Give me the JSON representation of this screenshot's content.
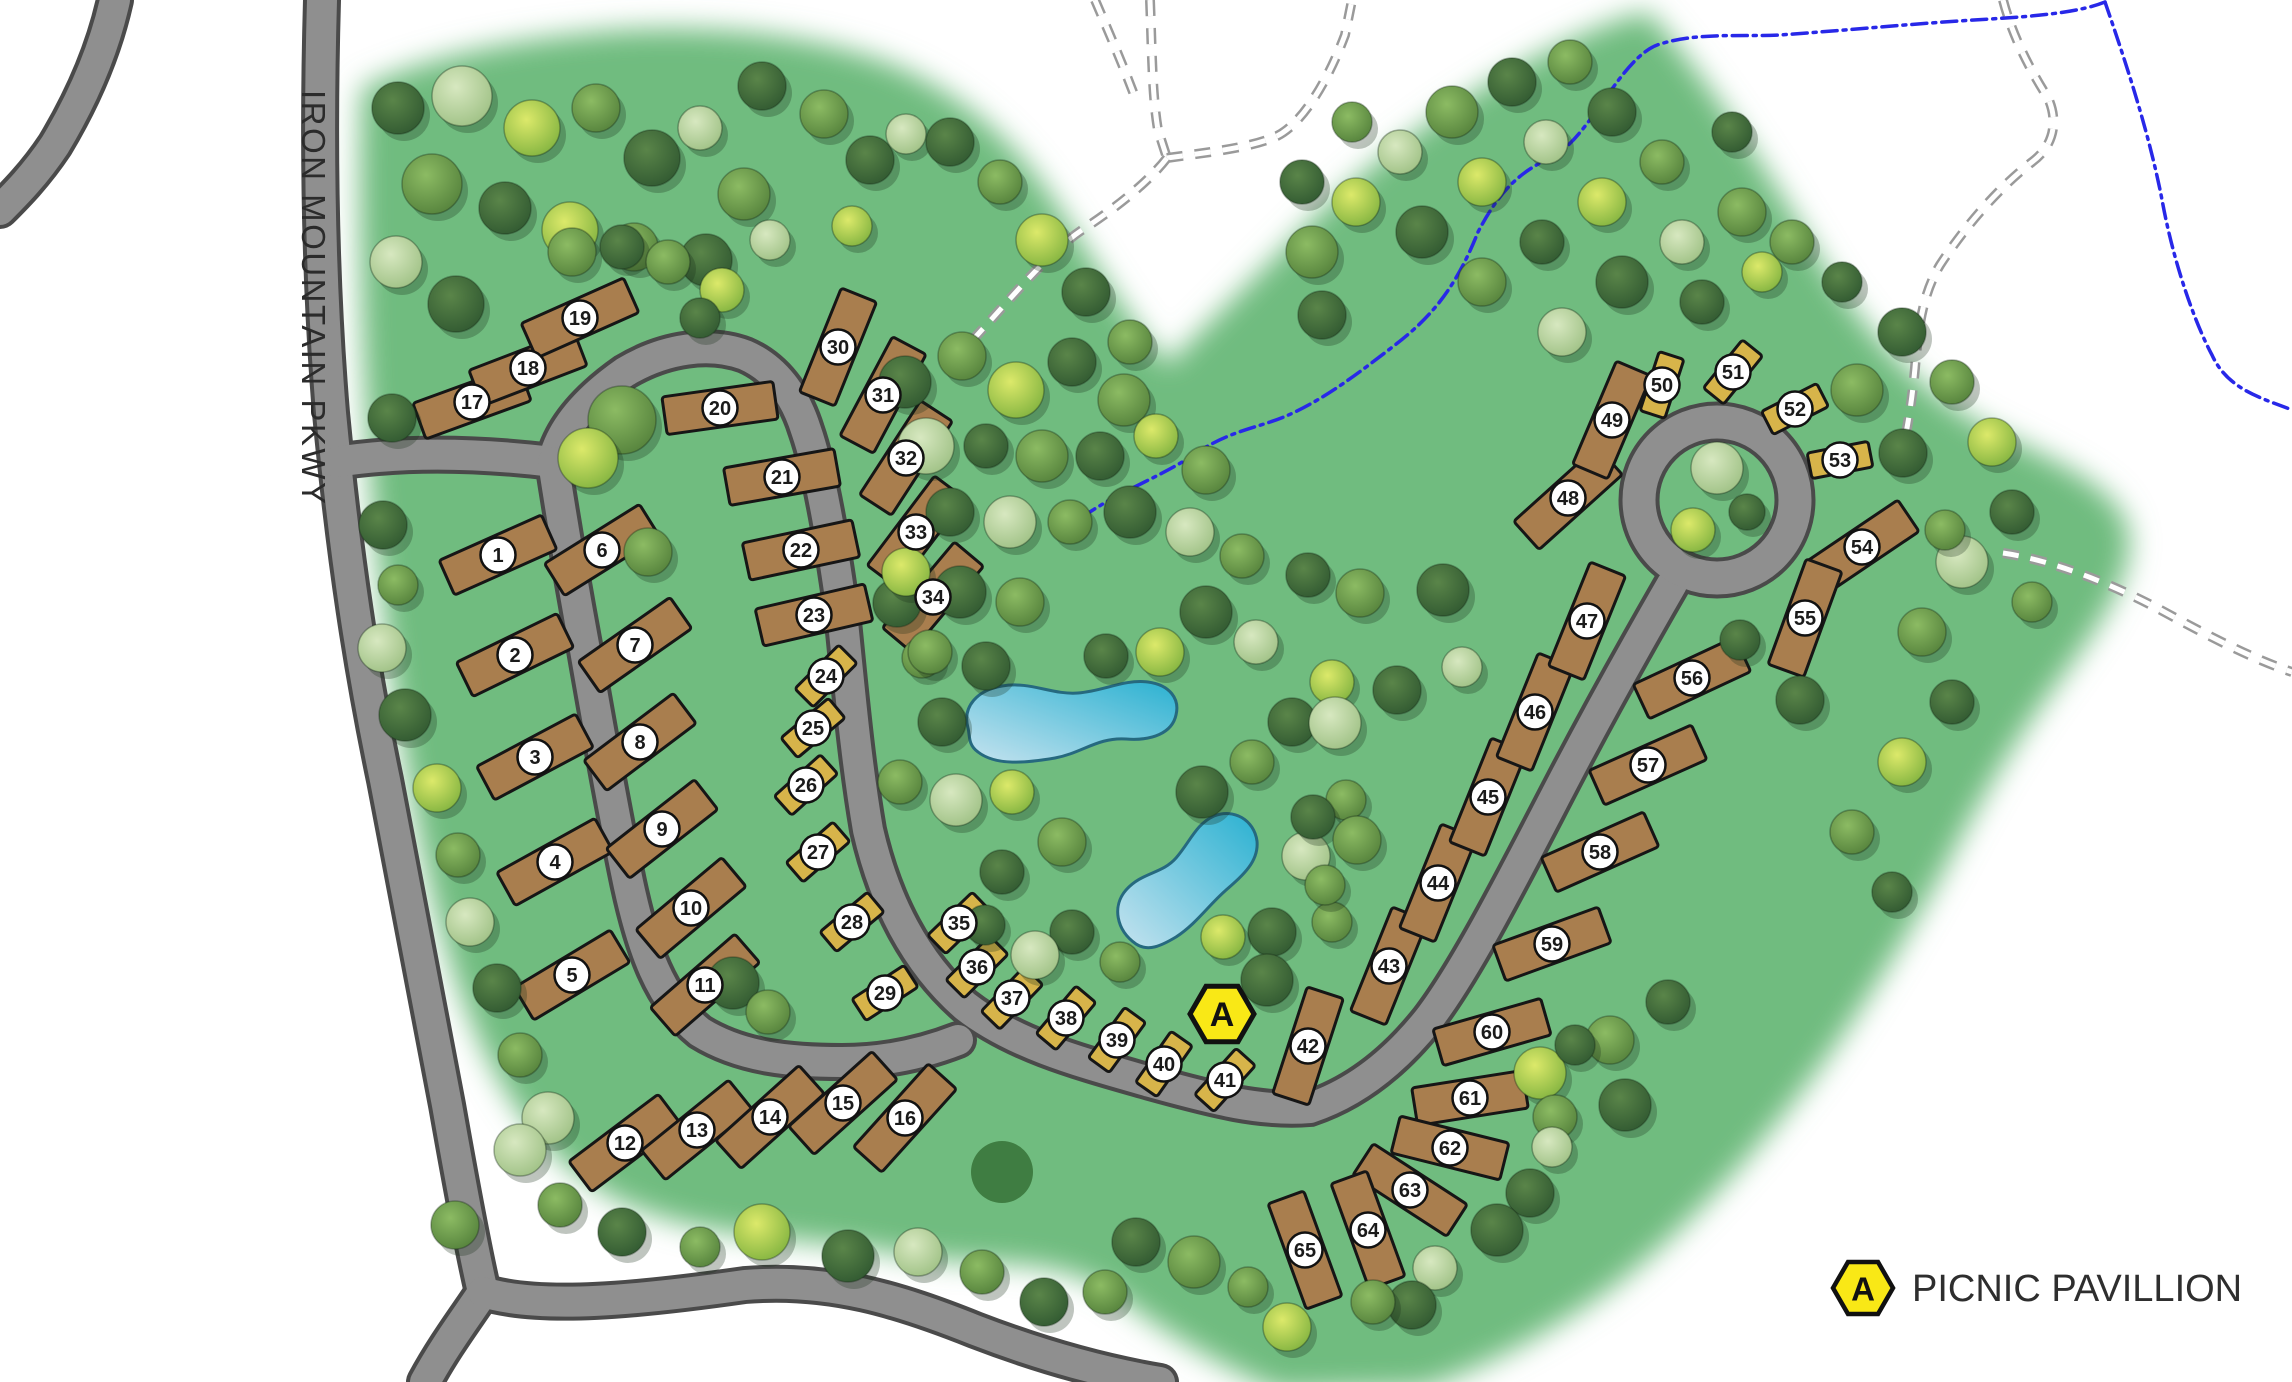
{
  "road_label": "IRON MOUNTAIN PKWY",
  "legend": {
    "symbol": "A",
    "label": "PICNIC PAVILLION"
  },
  "pavilion": {
    "symbol": "A",
    "x": 1222,
    "y": 1014
  },
  "colors": {
    "grass": "#6fbc7f",
    "road": "#8f8f8f",
    "road_casing": "#4a4a4a",
    "lot_large": "#a97e4e",
    "lot_small": "#d7b44a",
    "lot_outline": "#161616",
    "stream": "#2828e8",
    "trail": "#9a9a9a",
    "pond_edge": "#26697f",
    "pavilion_fill": "#f9e816",
    "grove": "#3f7d42",
    "badge_fill": "#ffffff",
    "badge_stroke": "#111111",
    "badge_text": "#1a1a1a"
  },
  "grove": {
    "x": 1002,
    "y": 1172,
    "r": 31
  },
  "ring": {
    "x": 1717,
    "y": 500,
    "r": 78
  },
  "lots": [
    {
      "n": 1,
      "x": 498,
      "y": 555,
      "rot": -24,
      "size": "L"
    },
    {
      "n": 2,
      "x": 515,
      "y": 655,
      "rot": -26,
      "size": "L"
    },
    {
      "n": 3,
      "x": 535,
      "y": 757,
      "rot": -28,
      "size": "L"
    },
    {
      "n": 4,
      "x": 555,
      "y": 862,
      "rot": -29,
      "size": "L"
    },
    {
      "n": 5,
      "x": 572,
      "y": 975,
      "rot": -31,
      "size": "L"
    },
    {
      "n": 6,
      "x": 602,
      "y": 550,
      "rot": -32,
      "size": "L"
    },
    {
      "n": 7,
      "x": 635,
      "y": 645,
      "rot": -35,
      "size": "L"
    },
    {
      "n": 8,
      "x": 640,
      "y": 742,
      "rot": -37,
      "size": "L"
    },
    {
      "n": 9,
      "x": 662,
      "y": 829,
      "rot": -38,
      "size": "L"
    },
    {
      "n": 10,
      "x": 691,
      "y": 908,
      "rot": -40,
      "size": "L"
    },
    {
      "n": 11,
      "x": 705,
      "y": 985,
      "rot": -41,
      "size": "L"
    },
    {
      "n": 12,
      "x": 625,
      "y": 1143,
      "rot": -37,
      "size": "L"
    },
    {
      "n": 13,
      "x": 697,
      "y": 1130,
      "rot": -39,
      "size": "L"
    },
    {
      "n": 14,
      "x": 770,
      "y": 1117,
      "rot": -42,
      "size": "L"
    },
    {
      "n": 15,
      "x": 843,
      "y": 1103,
      "rot": -42,
      "size": "L"
    },
    {
      "n": 16,
      "x": 905,
      "y": 1118,
      "rot": -48,
      "size": "L"
    },
    {
      "n": 17,
      "x": 472,
      "y": 402,
      "rot": -20,
      "size": "L"
    },
    {
      "n": 18,
      "x": 528,
      "y": 368,
      "rot": -21,
      "size": "L"
    },
    {
      "n": 19,
      "x": 580,
      "y": 318,
      "rot": -24,
      "size": "L"
    },
    {
      "n": 20,
      "x": 720,
      "y": 408,
      "rot": -8,
      "size": "L"
    },
    {
      "n": 21,
      "x": 782,
      "y": 477,
      "rot": -10,
      "size": "L"
    },
    {
      "n": 22,
      "x": 801,
      "y": 550,
      "rot": -12,
      "size": "L"
    },
    {
      "n": 23,
      "x": 814,
      "y": 615,
      "rot": -13,
      "size": "L"
    },
    {
      "n": 24,
      "x": 826,
      "y": 676,
      "rot": -45,
      "size": "S"
    },
    {
      "n": 25,
      "x": 813,
      "y": 728,
      "rot": -40,
      "size": "S"
    },
    {
      "n": 26,
      "x": 806,
      "y": 785,
      "rot": -42,
      "size": "S"
    },
    {
      "n": 27,
      "x": 818,
      "y": 852,
      "rot": -41,
      "size": "S"
    },
    {
      "n": 28,
      "x": 852,
      "y": 922,
      "rot": -40,
      "size": "S"
    },
    {
      "n": 29,
      "x": 885,
      "y": 993,
      "rot": -33,
      "size": "S"
    },
    {
      "n": 30,
      "x": 838,
      "y": 347,
      "rot": -68,
      "size": "L"
    },
    {
      "n": 31,
      "x": 883,
      "y": 395,
      "rot": -62,
      "size": "L"
    },
    {
      "n": 32,
      "x": 906,
      "y": 458,
      "rot": -57,
      "size": "L"
    },
    {
      "n": 33,
      "x": 916,
      "y": 532,
      "rot": -53,
      "size": "L"
    },
    {
      "n": 34,
      "x": 933,
      "y": 597,
      "rot": -50,
      "size": "L"
    },
    {
      "n": 35,
      "x": 959,
      "y": 923,
      "rot": -44,
      "size": "S"
    },
    {
      "n": 36,
      "x": 977,
      "y": 967,
      "rot": -45,
      "size": "S"
    },
    {
      "n": 37,
      "x": 1012,
      "y": 998,
      "rot": -46,
      "size": "S"
    },
    {
      "n": 38,
      "x": 1066,
      "y": 1018,
      "rot": -50,
      "size": "S"
    },
    {
      "n": 39,
      "x": 1117,
      "y": 1040,
      "rot": -54,
      "size": "S"
    },
    {
      "n": 40,
      "x": 1164,
      "y": 1064,
      "rot": -55,
      "size": "S"
    },
    {
      "n": 41,
      "x": 1225,
      "y": 1080,
      "rot": -48,
      "size": "S"
    },
    {
      "n": 42,
      "x": 1308,
      "y": 1046,
      "rot": -72,
      "size": "L"
    },
    {
      "n": 43,
      "x": 1389,
      "y": 966,
      "rot": -68,
      "size": "L"
    },
    {
      "n": 44,
      "x": 1438,
      "y": 883,
      "rot": -68,
      "size": "L"
    },
    {
      "n": 45,
      "x": 1488,
      "y": 797,
      "rot": -68,
      "size": "L"
    },
    {
      "n": 46,
      "x": 1535,
      "y": 712,
      "rot": -68,
      "size": "L"
    },
    {
      "n": 47,
      "x": 1587,
      "y": 621,
      "rot": -68,
      "size": "L"
    },
    {
      "n": 48,
      "x": 1568,
      "y": 498,
      "rot": -42,
      "size": "L"
    },
    {
      "n": 49,
      "x": 1612,
      "y": 420,
      "rot": -67,
      "size": "L"
    },
    {
      "n": 50,
      "x": 1662,
      "y": 385,
      "rot": -72,
      "size": "S"
    },
    {
      "n": 51,
      "x": 1733,
      "y": 372,
      "rot": -51,
      "size": "S"
    },
    {
      "n": 52,
      "x": 1795,
      "y": 409,
      "rot": -27,
      "size": "S"
    },
    {
      "n": 53,
      "x": 1840,
      "y": 460,
      "rot": -11,
      "size": "S"
    },
    {
      "n": 54,
      "x": 1862,
      "y": 547,
      "rot": -34,
      "size": "L"
    },
    {
      "n": 55,
      "x": 1805,
      "y": 618,
      "rot": -70,
      "size": "L"
    },
    {
      "n": 56,
      "x": 1692,
      "y": 678,
      "rot": -25,
      "size": "L"
    },
    {
      "n": 57,
      "x": 1648,
      "y": 765,
      "rot": -24,
      "size": "L"
    },
    {
      "n": 58,
      "x": 1600,
      "y": 852,
      "rot": -24,
      "size": "L"
    },
    {
      "n": 59,
      "x": 1552,
      "y": 944,
      "rot": -20,
      "size": "L"
    },
    {
      "n": 60,
      "x": 1492,
      "y": 1032,
      "rot": -16,
      "size": "L"
    },
    {
      "n": 61,
      "x": 1470,
      "y": 1098,
      "rot": -9,
      "size": "L"
    },
    {
      "n": 62,
      "x": 1450,
      "y": 1148,
      "rot": 14,
      "size": "L"
    },
    {
      "n": 63,
      "x": 1410,
      "y": 1190,
      "rot": 33,
      "size": "L"
    },
    {
      "n": 64,
      "x": 1368,
      "y": 1230,
      "rot": 70,
      "size": "L"
    },
    {
      "n": 65,
      "x": 1305,
      "y": 1250,
      "rot": 70,
      "size": "L"
    }
  ],
  "trees": [
    [
      398,
      108,
      26,
      "d"
    ],
    [
      462,
      96,
      30,
      "l"
    ],
    [
      532,
      128,
      28,
      "y"
    ],
    [
      596,
      108,
      24,
      "m"
    ],
    [
      652,
      158,
      28,
      "d"
    ],
    [
      432,
      184,
      30,
      "m"
    ],
    [
      505,
      208,
      26,
      "d"
    ],
    [
      570,
      230,
      28,
      "y"
    ],
    [
      634,
      247,
      24,
      "m"
    ],
    [
      396,
      262,
      26,
      "l"
    ],
    [
      456,
      304,
      28,
      "d"
    ],
    [
      700,
      128,
      22,
      "l"
    ],
    [
      744,
      194,
      26,
      "m"
    ],
    [
      706,
      260,
      26,
      "d"
    ],
    [
      770,
      240,
      20,
      "l"
    ],
    [
      824,
      114,
      24,
      "m"
    ],
    [
      870,
      160,
      24,
      "d"
    ],
    [
      852,
      226,
      20,
      "y"
    ],
    [
      906,
      134,
      20,
      "l"
    ],
    [
      762,
      86,
      24,
      "d"
    ],
    [
      572,
      252,
      24,
      "m"
    ],
    [
      622,
      247,
      22,
      "d"
    ],
    [
      668,
      262,
      22,
      "m"
    ],
    [
      722,
      290,
      22,
      "y"
    ],
    [
      700,
      318,
      20,
      "d"
    ],
    [
      392,
      418,
      24,
      "d"
    ],
    [
      383,
      525,
      24,
      "d"
    ],
    [
      398,
      585,
      20,
      "m"
    ],
    [
      382,
      648,
      24,
      "l"
    ],
    [
      405,
      715,
      26,
      "d"
    ],
    [
      437,
      788,
      24,
      "y"
    ],
    [
      458,
      855,
      22,
      "m"
    ],
    [
      470,
      922,
      24,
      "l"
    ],
    [
      497,
      988,
      24,
      "d"
    ],
    [
      520,
      1055,
      22,
      "m"
    ],
    [
      548,
      1118,
      26,
      "l"
    ],
    [
      622,
      420,
      34,
      "m"
    ],
    [
      588,
      458,
      30,
      "y"
    ],
    [
      648,
      552,
      24,
      "m"
    ],
    [
      733,
      983,
      26,
      "d"
    ],
    [
      768,
      1012,
      22,
      "m"
    ],
    [
      897,
      603,
      24,
      "d"
    ],
    [
      922,
      658,
      20,
      "m"
    ],
    [
      455,
      1225,
      24,
      "m"
    ],
    [
      520,
      1150,
      26,
      "l"
    ],
    [
      560,
      1205,
      22,
      "m"
    ],
    [
      622,
      1232,
      24,
      "d"
    ],
    [
      700,
      1247,
      20,
      "m"
    ],
    [
      762,
      1232,
      28,
      "y"
    ],
    [
      848,
      1256,
      26,
      "d"
    ],
    [
      918,
      1252,
      24,
      "l"
    ],
    [
      982,
      1272,
      22,
      "m"
    ],
    [
      1044,
      1302,
      24,
      "d"
    ],
    [
      1105,
      1292,
      22,
      "m"
    ],
    [
      1136,
      1242,
      24,
      "d"
    ],
    [
      1194,
      1262,
      26,
      "m"
    ],
    [
      905,
      382,
      26,
      "d"
    ],
    [
      962,
      356,
      24,
      "m"
    ],
    [
      1016,
      390,
      28,
      "y"
    ],
    [
      1072,
      362,
      24,
      "d"
    ],
    [
      1124,
      400,
      26,
      "m"
    ],
    [
      926,
      446,
      28,
      "l"
    ],
    [
      986,
      446,
      22,
      "d"
    ],
    [
      1042,
      456,
      26,
      "m"
    ],
    [
      1100,
      456,
      24,
      "d"
    ],
    [
      1156,
      436,
      22,
      "y"
    ],
    [
      1206,
      470,
      24,
      "m"
    ],
    [
      950,
      512,
      24,
      "d"
    ],
    [
      1010,
      522,
      26,
      "l"
    ],
    [
      1070,
      522,
      22,
      "m"
    ],
    [
      1130,
      512,
      26,
      "d"
    ],
    [
      1190,
      532,
      24,
      "l"
    ],
    [
      1242,
      556,
      22,
      "m"
    ],
    [
      906,
      572,
      24,
      "y"
    ],
    [
      960,
      592,
      26,
      "d"
    ],
    [
      1020,
      602,
      24,
      "m"
    ],
    [
      1206,
      612,
      26,
      "d"
    ],
    [
      1256,
      642,
      22,
      "l"
    ],
    [
      930,
      652,
      22,
      "m"
    ],
    [
      986,
      666,
      24,
      "d"
    ],
    [
      1160,
      652,
      24,
      "y"
    ],
    [
      1106,
      656,
      22,
      "d"
    ],
    [
      942,
      722,
      24,
      "d"
    ],
    [
      900,
      782,
      22,
      "m"
    ],
    [
      956,
      800,
      26,
      "l"
    ],
    [
      1012,
      792,
      22,
      "y"
    ],
    [
      1202,
      792,
      26,
      "d"
    ],
    [
      1252,
      762,
      22,
      "m"
    ],
    [
      1292,
      722,
      24,
      "d"
    ],
    [
      1332,
      682,
      22,
      "y"
    ],
    [
      1062,
      842,
      24,
      "m"
    ],
    [
      1002,
      872,
      22,
      "d"
    ],
    [
      1306,
      856,
      24,
      "l"
    ],
    [
      1346,
      800,
      20,
      "m"
    ],
    [
      1072,
      932,
      22,
      "d"
    ],
    [
      985,
      925,
      20,
      "d"
    ],
    [
      1035,
      955,
      24,
      "l"
    ],
    [
      1120,
      962,
      20,
      "m"
    ],
    [
      1272,
      932,
      24,
      "d"
    ],
    [
      1332,
      922,
      20,
      "m"
    ],
    [
      950,
      142,
      24,
      "d"
    ],
    [
      1000,
      182,
      22,
      "m"
    ],
    [
      1042,
      240,
      26,
      "y"
    ],
    [
      1086,
      292,
      24,
      "d"
    ],
    [
      1130,
      342,
      22,
      "m"
    ],
    [
      1322,
      315,
      24,
      "d"
    ],
    [
      1312,
      252,
      26,
      "m"
    ],
    [
      1356,
      202,
      24,
      "y"
    ],
    [
      1400,
      152,
      22,
      "l"
    ],
    [
      1452,
      112,
      26,
      "m"
    ],
    [
      1512,
      82,
      24,
      "d"
    ],
    [
      1570,
      62,
      22,
      "m"
    ],
    [
      1302,
      182,
      22,
      "d"
    ],
    [
      1352,
      122,
      20,
      "m"
    ],
    [
      1422,
      232,
      26,
      "d"
    ],
    [
      1482,
      182,
      24,
      "y"
    ],
    [
      1546,
      142,
      22,
      "l"
    ],
    [
      1612,
      112,
      24,
      "d"
    ],
    [
      1482,
      282,
      24,
      "m"
    ],
    [
      1542,
      242,
      22,
      "d"
    ],
    [
      1602,
      202,
      24,
      "y"
    ],
    [
      1662,
      162,
      22,
      "m"
    ],
    [
      1622,
      282,
      26,
      "d"
    ],
    [
      1682,
      242,
      22,
      "l"
    ],
    [
      1742,
      212,
      24,
      "m"
    ],
    [
      1702,
      302,
      22,
      "d"
    ],
    [
      1762,
      272,
      20,
      "y"
    ],
    [
      1562,
      332,
      24,
      "l"
    ],
    [
      1732,
      132,
      20,
      "d"
    ],
    [
      1792,
      242,
      22,
      "m"
    ],
    [
      1842,
      282,
      20,
      "d"
    ],
    [
      1902,
      332,
      24,
      "d"
    ],
    [
      1952,
      382,
      22,
      "m"
    ],
    [
      1992,
      442,
      24,
      "y"
    ],
    [
      2012,
      512,
      22,
      "d"
    ],
    [
      1962,
      562,
      26,
      "l"
    ],
    [
      1922,
      632,
      24,
      "m"
    ],
    [
      1952,
      702,
      22,
      "d"
    ],
    [
      1902,
      762,
      24,
      "y"
    ],
    [
      1852,
      832,
      22,
      "m"
    ],
    [
      1892,
      892,
      20,
      "d"
    ],
    [
      2032,
      602,
      20,
      "m"
    ],
    [
      1717,
      468,
      26,
      "l"
    ],
    [
      1693,
      530,
      22,
      "y"
    ],
    [
      1747,
      512,
      18,
      "d"
    ],
    [
      1857,
      390,
      26,
      "m"
    ],
    [
      1903,
      453,
      24,
      "d"
    ],
    [
      1945,
      530,
      20,
      "m"
    ],
    [
      1308,
      575,
      22,
      "d"
    ],
    [
      1360,
      593,
      24,
      "m"
    ],
    [
      1443,
      590,
      26,
      "d"
    ],
    [
      1462,
      667,
      20,
      "l"
    ],
    [
      1397,
      690,
      24,
      "d"
    ],
    [
      1335,
      723,
      26,
      "l"
    ],
    [
      1313,
      817,
      22,
      "d"
    ],
    [
      1357,
      840,
      24,
      "m"
    ],
    [
      1325,
      885,
      20,
      "m"
    ],
    [
      1740,
      640,
      20,
      "d"
    ],
    [
      1800,
      700,
      24,
      "d"
    ],
    [
      1223,
      937,
      22,
      "y"
    ],
    [
      1267,
      980,
      26,
      "d"
    ],
    [
      1540,
      1073,
      26,
      "y"
    ],
    [
      1555,
      1117,
      22,
      "m"
    ],
    [
      1552,
      1147,
      20,
      "l"
    ],
    [
      1530,
      1193,
      24,
      "d"
    ],
    [
      1497,
      1230,
      26,
      "d"
    ],
    [
      1435,
      1268,
      22,
      "l"
    ],
    [
      1412,
      1305,
      24,
      "d"
    ],
    [
      1373,
      1302,
      22,
      "m"
    ],
    [
      1287,
      1327,
      24,
      "y"
    ],
    [
      1248,
      1287,
      20,
      "m"
    ],
    [
      1610,
      1040,
      24,
      "m"
    ],
    [
      1668,
      1002,
      22,
      "d"
    ],
    [
      1625,
      1105,
      26,
      "d"
    ],
    [
      1575,
      1045,
      20,
      "d"
    ]
  ]
}
